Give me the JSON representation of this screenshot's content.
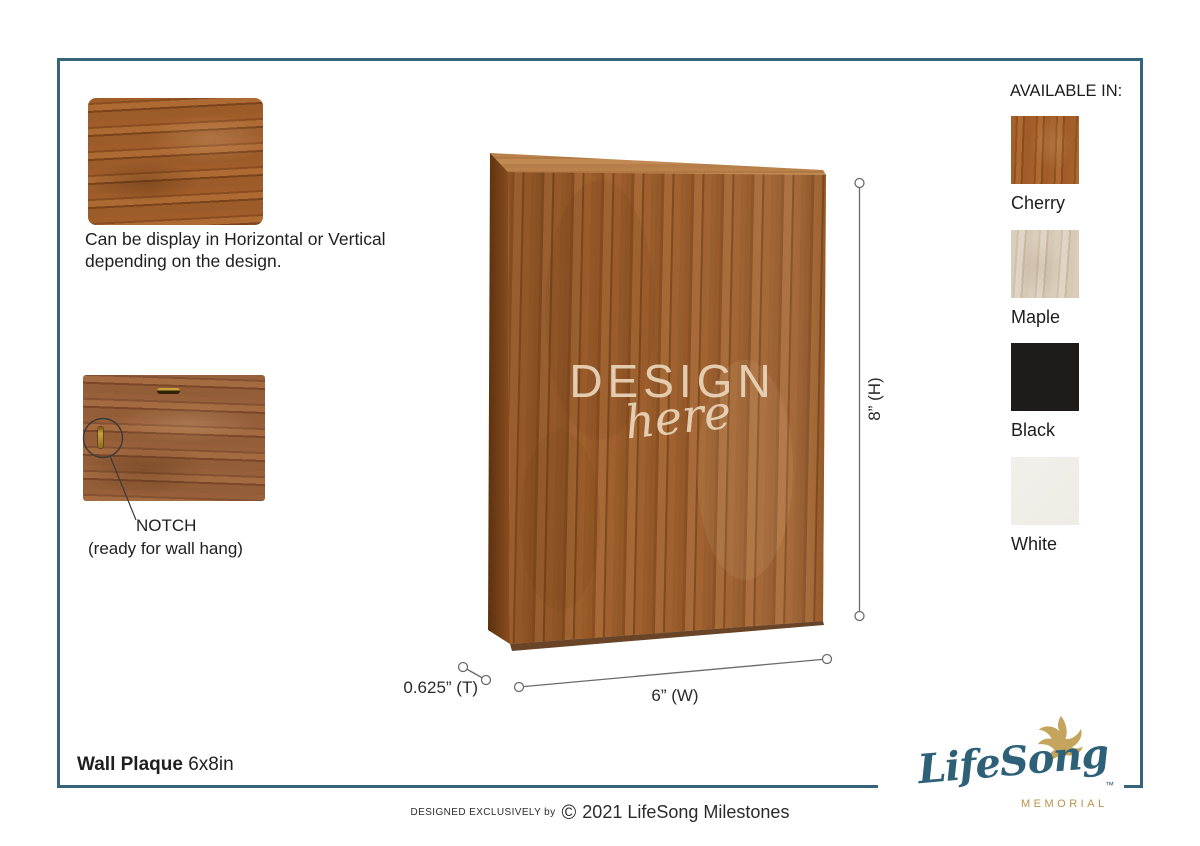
{
  "theme": {
    "frame_color": "#35647b",
    "wood_brown": "#a2622e",
    "engraving_color": "#ebd8be",
    "dimension_line_color": "#6b6b6b"
  },
  "orientation_note": {
    "line1": "Can be display in Horizontal or Vertical",
    "line2": "depending on the design."
  },
  "notch_note": {
    "line1": "NOTCH",
    "line2": "(ready for wall hang)"
  },
  "plaque": {
    "design_word": "DESIGN",
    "here_word": "here"
  },
  "dimensions": {
    "height_label": "8” (H)",
    "width_label": "6” (W)",
    "thickness_label": "0.625” (T)"
  },
  "available_in": {
    "title": "AVAILABLE IN:",
    "options": [
      {
        "label": "Cherry",
        "color": "#a3602b"
      },
      {
        "label": "Maple",
        "color": "#d9cdbb"
      },
      {
        "label": "Black",
        "color": "#1e1c1b"
      },
      {
        "label": "White",
        "color": "#f0efea"
      }
    ]
  },
  "footer": {
    "product_name": "Wall Plaque",
    "product_size": "6x8in",
    "designed_by": "DESIGNED EXCLUSIVELY by",
    "copyright_symbol": "©",
    "copyright_text": "2021 LifeSong Milestones"
  },
  "brand": {
    "logo_text": "LifeSong",
    "logo_sub": "MEMORIAL",
    "trademark": "™",
    "accent_teal": "#2e6078",
    "accent_gold": "#b8924a"
  }
}
